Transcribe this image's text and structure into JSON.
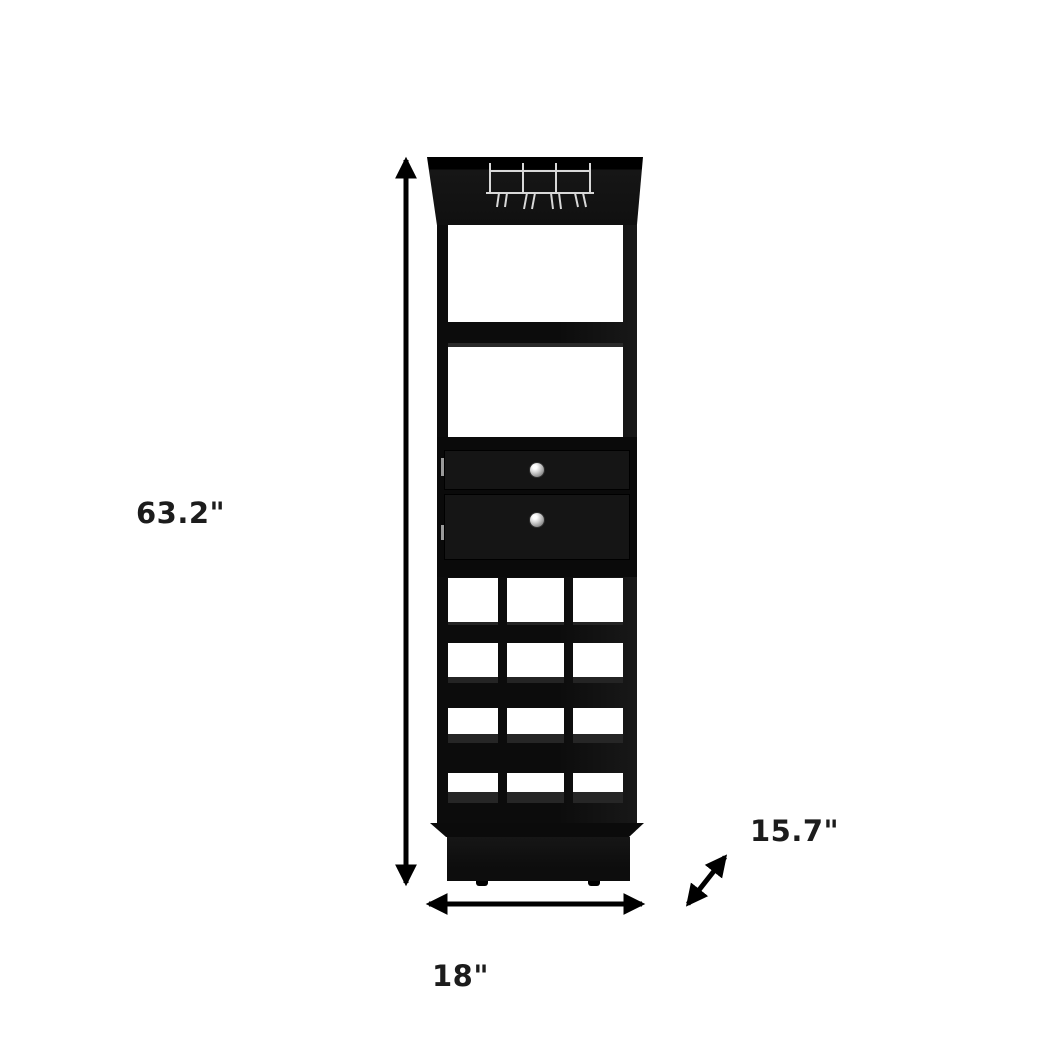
{
  "diagram": {
    "type": "product-dimension-diagram",
    "subject": "black bar cabinet with stemware rack, two open shelves, two drawers and 12-bottle wine cubby grid",
    "dimensions": {
      "height_label": "63.2\"",
      "width_label": "18\"",
      "depth_label": "15.7\""
    },
    "wine_rack": {
      "rows": 4,
      "columns": 3
    },
    "drawer_count": 2,
    "colors": {
      "background": "#ffffff",
      "cabinet_black": "#121212",
      "arrow_black": "#000000",
      "knob_silver": "#c8c8c8",
      "rack_wire_silver": "#d8d8d8"
    }
  }
}
